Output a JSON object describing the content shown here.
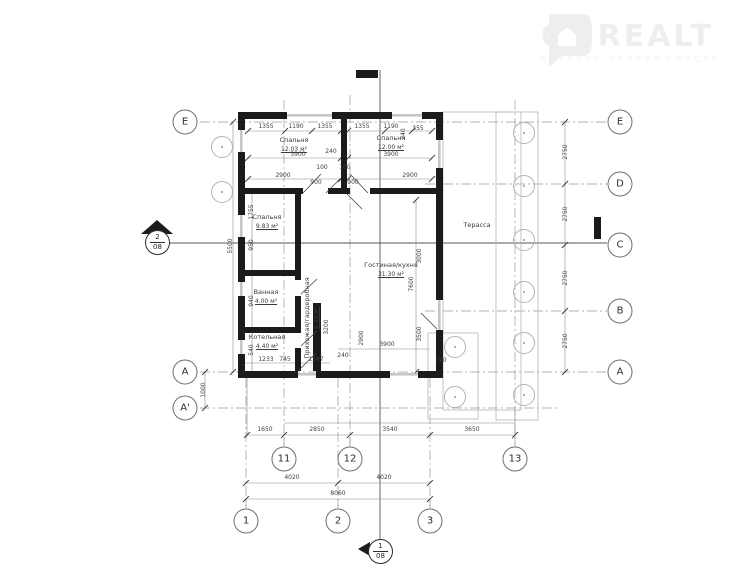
{
  "watermark": {
    "brand": "ONREALT",
    "tagline": "КАТАЛОГ НЕДВИЖИМОСТИ"
  },
  "colors": {
    "wall": "#1b1b1b",
    "thin_line": "#b5b5b5",
    "axis_line": "#9a9a9a",
    "dim_text": "#3f3f3f",
    "watermark": "#eceef0"
  },
  "rooms": [
    {
      "id": "bedroom-1",
      "name": "Спальня",
      "area": "12.03 м²",
      "x": 294,
      "y": 145
    },
    {
      "id": "bedroom-2",
      "name": "Спальня",
      "area": "12.00 м²",
      "x": 391,
      "y": 143
    },
    {
      "id": "bedroom-3",
      "name": "Спальня",
      "area": "9.83 м²",
      "x": 267,
      "y": 222
    },
    {
      "id": "bathroom",
      "name": "Ванная",
      "area": "4.00 м²",
      "x": 266,
      "y": 297
    },
    {
      "id": "boiler",
      "name": "Котельная",
      "area": "4.40 м²",
      "x": 267,
      "y": 342
    },
    {
      "id": "hall-wardrobe",
      "name": "Прихожая/гардеробная",
      "area": "5.35 м²",
      "x": 312,
      "y": 318,
      "rot": 1
    },
    {
      "id": "living-kitchen",
      "name": "Гостиная/кухня",
      "area": "31.30 м²",
      "x": 391,
      "y": 270
    },
    {
      "id": "terrace",
      "name": "Терасса",
      "area": "",
      "x": 477,
      "y": 226
    }
  ],
  "axis_bubbles": [
    {
      "label": "E",
      "x": 185,
      "y": 122
    },
    {
      "label": "A",
      "x": 185,
      "y": 372
    },
    {
      "label": "A'",
      "x": 185,
      "y": 408
    },
    {
      "label": "E",
      "x": 620,
      "y": 122
    },
    {
      "label": "D",
      "x": 620,
      "y": 184
    },
    {
      "label": "C",
      "x": 620,
      "y": 245
    },
    {
      "label": "B",
      "x": 620,
      "y": 311
    },
    {
      "label": "A",
      "x": 620,
      "y": 372
    },
    {
      "label": "11",
      "x": 284,
      "y": 459
    },
    {
      "label": "12",
      "x": 350,
      "y": 459
    },
    {
      "label": "13",
      "x": 515,
      "y": 459
    },
    {
      "label": "1",
      "x": 246,
      "y": 521
    },
    {
      "label": "2",
      "x": 338,
      "y": 521
    },
    {
      "label": "3",
      "x": 430,
      "y": 521
    }
  ],
  "dims": [
    {
      "t": "1355",
      "x": 266,
      "y": 127
    },
    {
      "t": "1190",
      "x": 296,
      "y": 127
    },
    {
      "t": "1355",
      "x": 325,
      "y": 127
    },
    {
      "t": "1355",
      "x": 362,
      "y": 127
    },
    {
      "t": "1190",
      "x": 391,
      "y": 127
    },
    {
      "t": "355",
      "x": 418,
      "y": 129
    },
    {
      "t": "240",
      "x": 404,
      "y": 134,
      "r": 1
    },
    {
      "t": "3900",
      "x": 298,
      "y": 155
    },
    {
      "t": "240",
      "x": 331,
      "y": 152
    },
    {
      "t": "3900",
      "x": 391,
      "y": 155
    },
    {
      "t": "2900",
      "x": 283,
      "y": 176
    },
    {
      "t": "2900",
      "x": 410,
      "y": 176
    },
    {
      "t": "100",
      "x": 322,
      "y": 168
    },
    {
      "t": "100",
      "x": 345,
      "y": 168
    },
    {
      "t": "900",
      "x": 316,
      "y": 183
    },
    {
      "t": "900",
      "x": 353,
      "y": 183
    },
    {
      "t": "1755",
      "x": 252,
      "y": 212,
      "r": 1
    },
    {
      "t": "950",
      "x": 252,
      "y": 245,
      "r": 1
    },
    {
      "t": "940",
      "x": 252,
      "y": 301,
      "r": 1
    },
    {
      "t": "540",
      "x": 252,
      "y": 350,
      "r": 1
    },
    {
      "t": "5500",
      "x": 231,
      "y": 246,
      "r": 1
    },
    {
      "t": "1000",
      "x": 204,
      "y": 390,
      "r": 1
    },
    {
      "t": "3200",
      "x": 327,
      "y": 327,
      "r": 1
    },
    {
      "t": "3000",
      "x": 420,
      "y": 256,
      "r": 1
    },
    {
      "t": "7600",
      "x": 412,
      "y": 284,
      "r": 1
    },
    {
      "t": "3500",
      "x": 420,
      "y": 334,
      "r": 1
    },
    {
      "t": "2900",
      "x": 362,
      "y": 338,
      "r": 1
    },
    {
      "t": "3900",
      "x": 387,
      "y": 345
    },
    {
      "t": "790",
      "x": 441,
      "y": 361
    },
    {
      "t": "1233",
      "x": 266,
      "y": 360
    },
    {
      "t": "745",
      "x": 285,
      "y": 360
    },
    {
      "t": "1587",
      "x": 316,
      "y": 360
    },
    {
      "t": "240",
      "x": 343,
      "y": 356
    },
    {
      "t": "2750",
      "x": 566,
      "y": 152,
      "r": 1
    },
    {
      "t": "2750",
      "x": 566,
      "y": 214,
      "r": 1
    },
    {
      "t": "2750",
      "x": 566,
      "y": 278,
      "r": 1
    },
    {
      "t": "2750",
      "x": 566,
      "y": 341,
      "r": 1
    },
    {
      "t": "1650",
      "x": 265,
      "y": 430
    },
    {
      "t": "2850",
      "x": 317,
      "y": 430
    },
    {
      "t": "3540",
      "x": 390,
      "y": 430
    },
    {
      "t": "3650",
      "x": 472,
      "y": 430
    },
    {
      "t": "4020",
      "x": 292,
      "y": 478
    },
    {
      "t": "4020",
      "x": 384,
      "y": 478
    },
    {
      "t": "8060",
      "x": 338,
      "y": 494
    }
  ],
  "columns": [
    {
      "x": 524,
      "y": 133
    },
    {
      "x": 524,
      "y": 186
    },
    {
      "x": 524,
      "y": 240
    },
    {
      "x": 524,
      "y": 292
    },
    {
      "x": 524,
      "y": 343
    },
    {
      "x": 524,
      "y": 395
    },
    {
      "x": 455,
      "y": 347
    },
    {
      "x": 455,
      "y": 397
    },
    {
      "x": 222,
      "y": 147
    },
    {
      "x": 222,
      "y": 192
    }
  ],
  "section_markers": [
    {
      "num": "2",
      "sheet": "08"
    },
    {
      "num": "1",
      "sheet": "08"
    }
  ]
}
